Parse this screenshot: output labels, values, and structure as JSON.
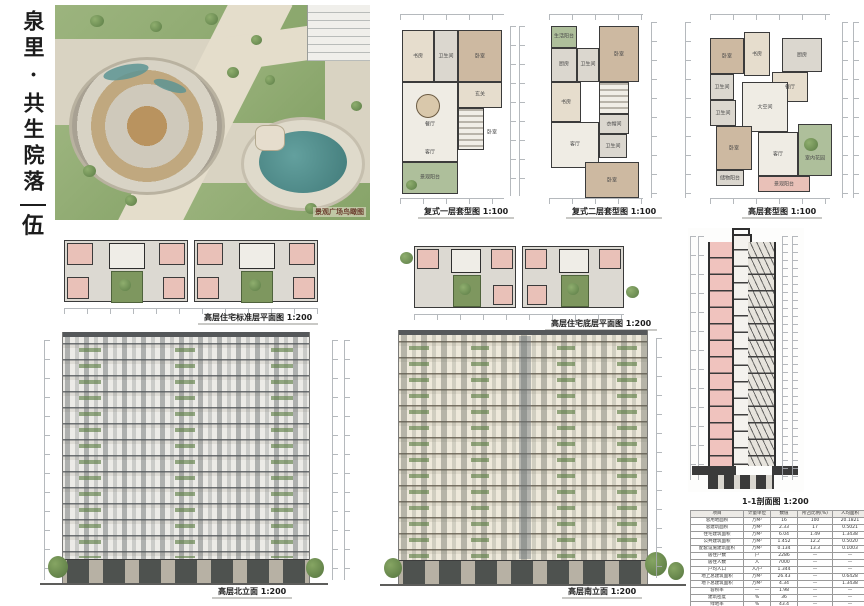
{
  "board": {
    "title": "泉里·共生院落",
    "title_number": "伍"
  },
  "aerial": {
    "caption": "景观广场鸟瞰图"
  },
  "unit_plans": {
    "duplex1": {
      "caption": "复式一层套型图 1:100",
      "rooms": [
        "书房",
        "卫生间",
        "卧室",
        "餐厅",
        "玄关",
        "卧室",
        "客厅",
        "景观阳台"
      ]
    },
    "duplex2": {
      "caption": "复式二层套型图 1:100",
      "rooms": [
        "生活阳台",
        "厨房",
        "卫生间",
        "卧室",
        "书房",
        "客厅",
        "衣帽间",
        "卫生间",
        "卧室"
      ]
    },
    "highrise": {
      "caption": "高层套型图 1:100",
      "rooms": [
        "卧室",
        "书房",
        "厨房",
        "餐厅",
        "卫生间",
        "卫生间",
        "卧室",
        "大空间",
        "客厅",
        "室内花园",
        "储物阳台",
        "景观阳台"
      ]
    }
  },
  "floor_plans": {
    "standard": {
      "caption": "高层住宅标准层平面图 1:200"
    },
    "ground": {
      "caption": "高层住宅底层平面图 1:200"
    }
  },
  "elevations": {
    "north": {
      "caption": "高层北立面 1:200"
    },
    "south": {
      "caption": "高层南立面 1:200"
    }
  },
  "section": {
    "caption": "1-1剖面图 1:200"
  },
  "table": {
    "headers": [
      "项目",
      "计量单位",
      "数值",
      "所占比例(%)",
      "人均面积"
    ],
    "rows": [
      [
        "总用地面积",
        "万M²",
        "16",
        "100",
        "20.1821"
      ],
      [
        "总建筑面积",
        "万M²",
        "2.33",
        "17",
        "0.5021"
      ],
      [
        "住宅建筑面积",
        "万M²",
        "6.04",
        "1.49",
        "1.3438"
      ],
      [
        "公共建筑面积",
        "万M²",
        "1.452",
        "12.2",
        "0.5020"
      ],
      [
        "配套设施建筑面积",
        "万M²",
        "0.134",
        "13.3",
        "0.1003"
      ],
      [
        "居住户数",
        "户",
        "2286",
        "—",
        "—"
      ],
      [
        "居住人数",
        "人",
        "7000",
        "—",
        "—"
      ],
      [
        "户均人口",
        "人/户",
        "1.344",
        "—",
        "—"
      ],
      [
        "地上总建筑面积",
        "万M²",
        "26.43",
        "—",
        "0.6428"
      ],
      [
        "地下总建筑面积",
        "万M²",
        "4.34",
        "—",
        "1.3438"
      ],
      [
        "容积率",
        "—",
        "1.98",
        "—",
        "—"
      ],
      [
        "建筑密度",
        "%",
        "36",
        "—",
        "—"
      ],
      [
        "绿地率",
        "%",
        "43.4",
        "—",
        "—"
      ]
    ]
  }
}
